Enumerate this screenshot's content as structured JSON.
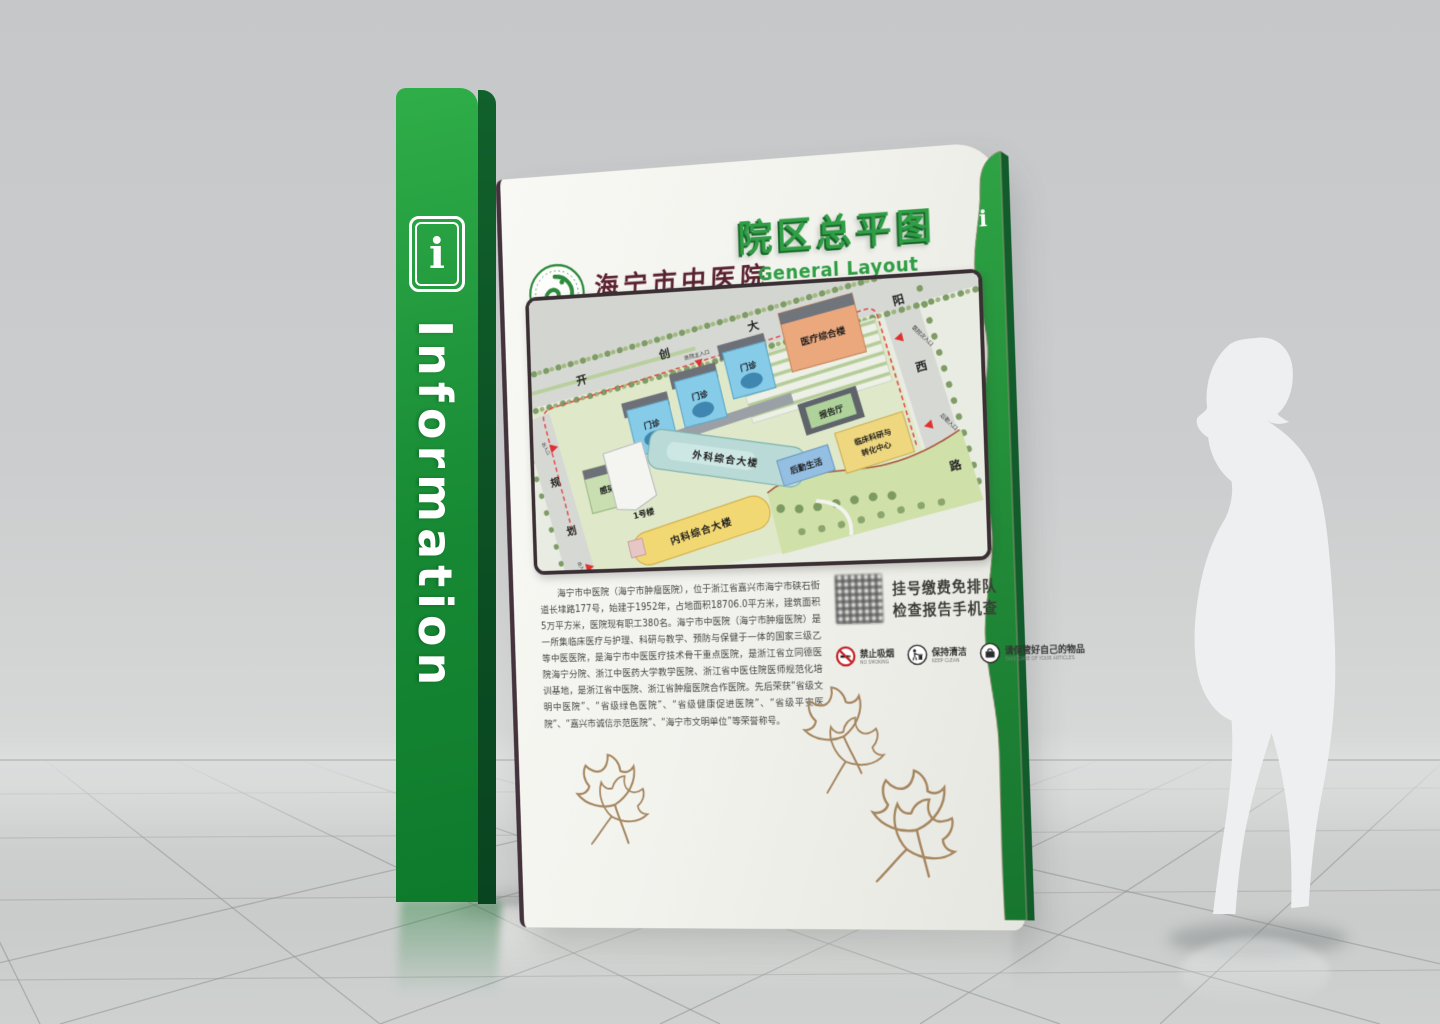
{
  "pillar": {
    "icon": "i",
    "label": "Information"
  },
  "side_tab": {
    "icon": "i"
  },
  "board": {
    "logo": {
      "name_cn": "海宁市中医院",
      "name_en": "HAINING TRADITIONAL CHINESE MEDICINE HOSPITAL"
    },
    "title": {
      "cn": "院区总平图",
      "en": "General Layout"
    },
    "map": {
      "roads": {
        "top": [
          "开",
          "创",
          "大"
        ],
        "right": [
          "阳",
          "西",
          "路"
        ],
        "left": [
          "规",
          "划"
        ]
      },
      "entrances": [
        {
          "label": "医院主入口"
        },
        {
          "label": "医院次入口"
        },
        {
          "label": "后勤入口"
        },
        {
          "label": "出入口"
        },
        {
          "label": "出入口"
        }
      ],
      "buildings": [
        {
          "label": "感染楼",
          "color": "#c9dfb2"
        },
        {
          "label": "门诊",
          "color": "#86cbe7"
        },
        {
          "label": "门诊",
          "color": "#86cbe7"
        },
        {
          "label": "门诊",
          "color": "#86cbe7"
        },
        {
          "label": "1号楼",
          "color": "#f4f4f1"
        },
        {
          "label": "外科综合大楼",
          "color": "#b9dad6"
        },
        {
          "label": "内科综合大楼",
          "color": "#f2d873"
        },
        {
          "label": "医疗综合楼",
          "color": "#eba87c"
        },
        {
          "label": "报告厅",
          "color": "#aed29a"
        },
        {
          "label": "临床科研与转化中心",
          "line1": "临床科研与",
          "line2": "转化中心",
          "color": "#efd77f"
        },
        {
          "label": "后勤生活",
          "color": "#95bfe2"
        }
      ]
    },
    "intro": "海宁市中医院（海宁市肿瘤医院），位于浙江省嘉兴市海宁市硖石街道长埭路177号，始建于1952年，占地面积18706.0平方米，建筑面积5万平方米，医院现有职工380名。海宁市中医院（海宁市肿瘤医院）是一所集临床医疗与护理、科研与教学、预防与保健于一体的国家三级乙等中医医院，是海宁市中医医疗技术骨干重点医院，是浙江省立同德医院海宁分院、浙江中医药大学教学医院、浙江省中医住院医师规范化培训基地，是浙江省中医院、浙江省肿瘤医院合作医院。先后荣获“省级文明中医院”、“省级绿色医院”、“省级健康促进医院”、“省级平安医院”、“嘉兴市诚信示范医院”、“海宁市文明单位”等荣誉称号。",
    "qr_notice": {
      "line1": "挂号缴费免排队",
      "line2": "检查报告手机查"
    },
    "rules": [
      {
        "cn": "禁止吸烟",
        "en": "NO SMOKING"
      },
      {
        "cn": "保持清洁",
        "en": "KEEP CLEAN"
      },
      {
        "cn": "请保管好自己的物品",
        "en": "TAKE CARE OF YOUR ARTICLES"
      }
    ]
  },
  "colors": {
    "brand_green": "#1f9c3d",
    "dark_green": "#0d5f28",
    "title_green": "#2f9e44",
    "calligraphy_maroon": "#5b2230",
    "boundary_red": "#e34b4b",
    "leaf_tan": "#a5865f"
  }
}
